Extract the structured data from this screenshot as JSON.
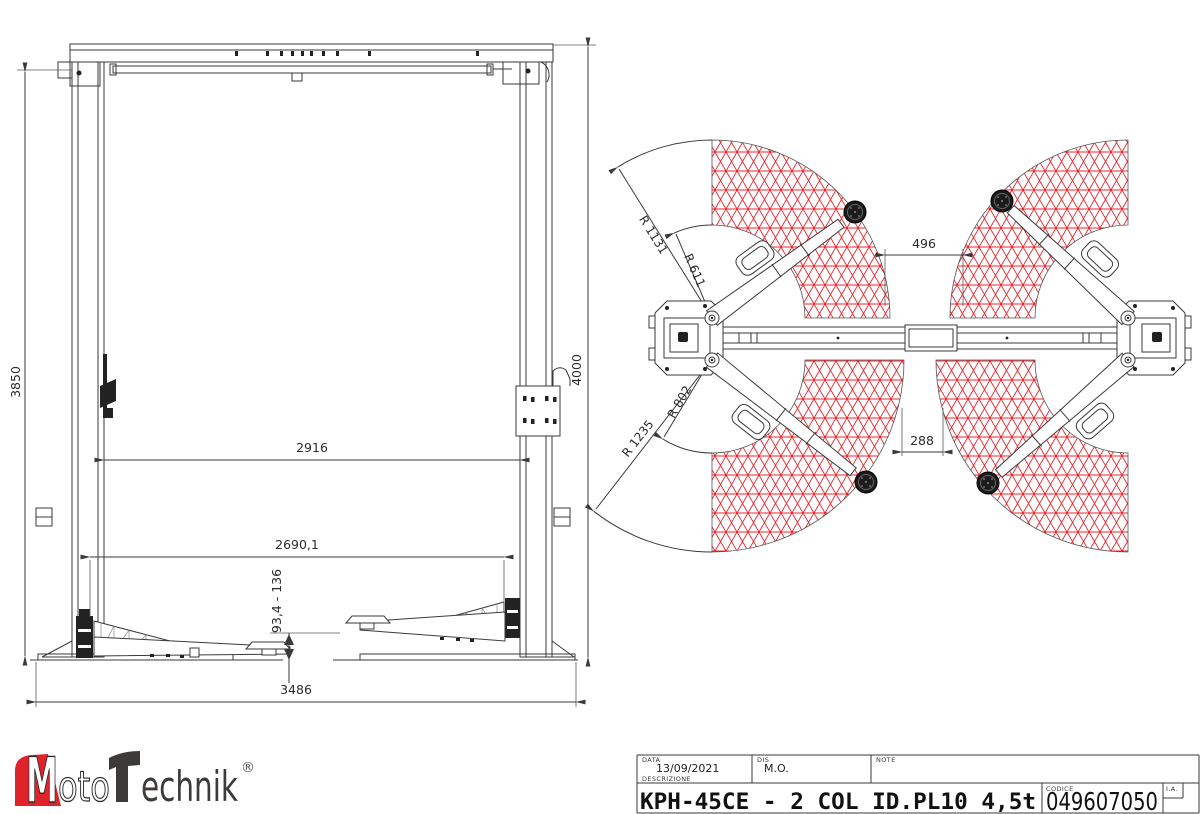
{
  "colors": {
    "hatch_red": "#e8242c",
    "line": "#3a3a3a",
    "logo_red": "#e0222a",
    "logo_dark": "#3c3b39"
  },
  "front_view": {
    "dims": {
      "height_left": "3850",
      "height_right": "4000",
      "clear_width": "2916",
      "drive_width": "2690,1",
      "pad_height_range": "93,4 - 136",
      "base_width": "3486"
    }
  },
  "top_view": {
    "dims": {
      "gap_front": "496",
      "gap_rear": "288",
      "r_front_max": "R 1131",
      "r_front_min": "R 611",
      "r_rear_max": "R 1235",
      "r_rear_min": "R 802"
    }
  },
  "logo": {
    "m": "M",
    "oto": "oto",
    "t_echnik": "echnik",
    "reg": "®"
  },
  "title_block": {
    "data_label": "DATA",
    "data_value": "13/09/2021",
    "dis_label": "DIS",
    "dis_value": "M.O.",
    "note_label": "NOTE",
    "descrizione_label": "DESCRIZIONE",
    "descrizione_value": "KPH-45CE - 2 COL ID.PL10 4,5t",
    "codice_label": "CODICE",
    "codice_value": "049607050",
    "ia_label": "I.A."
  }
}
